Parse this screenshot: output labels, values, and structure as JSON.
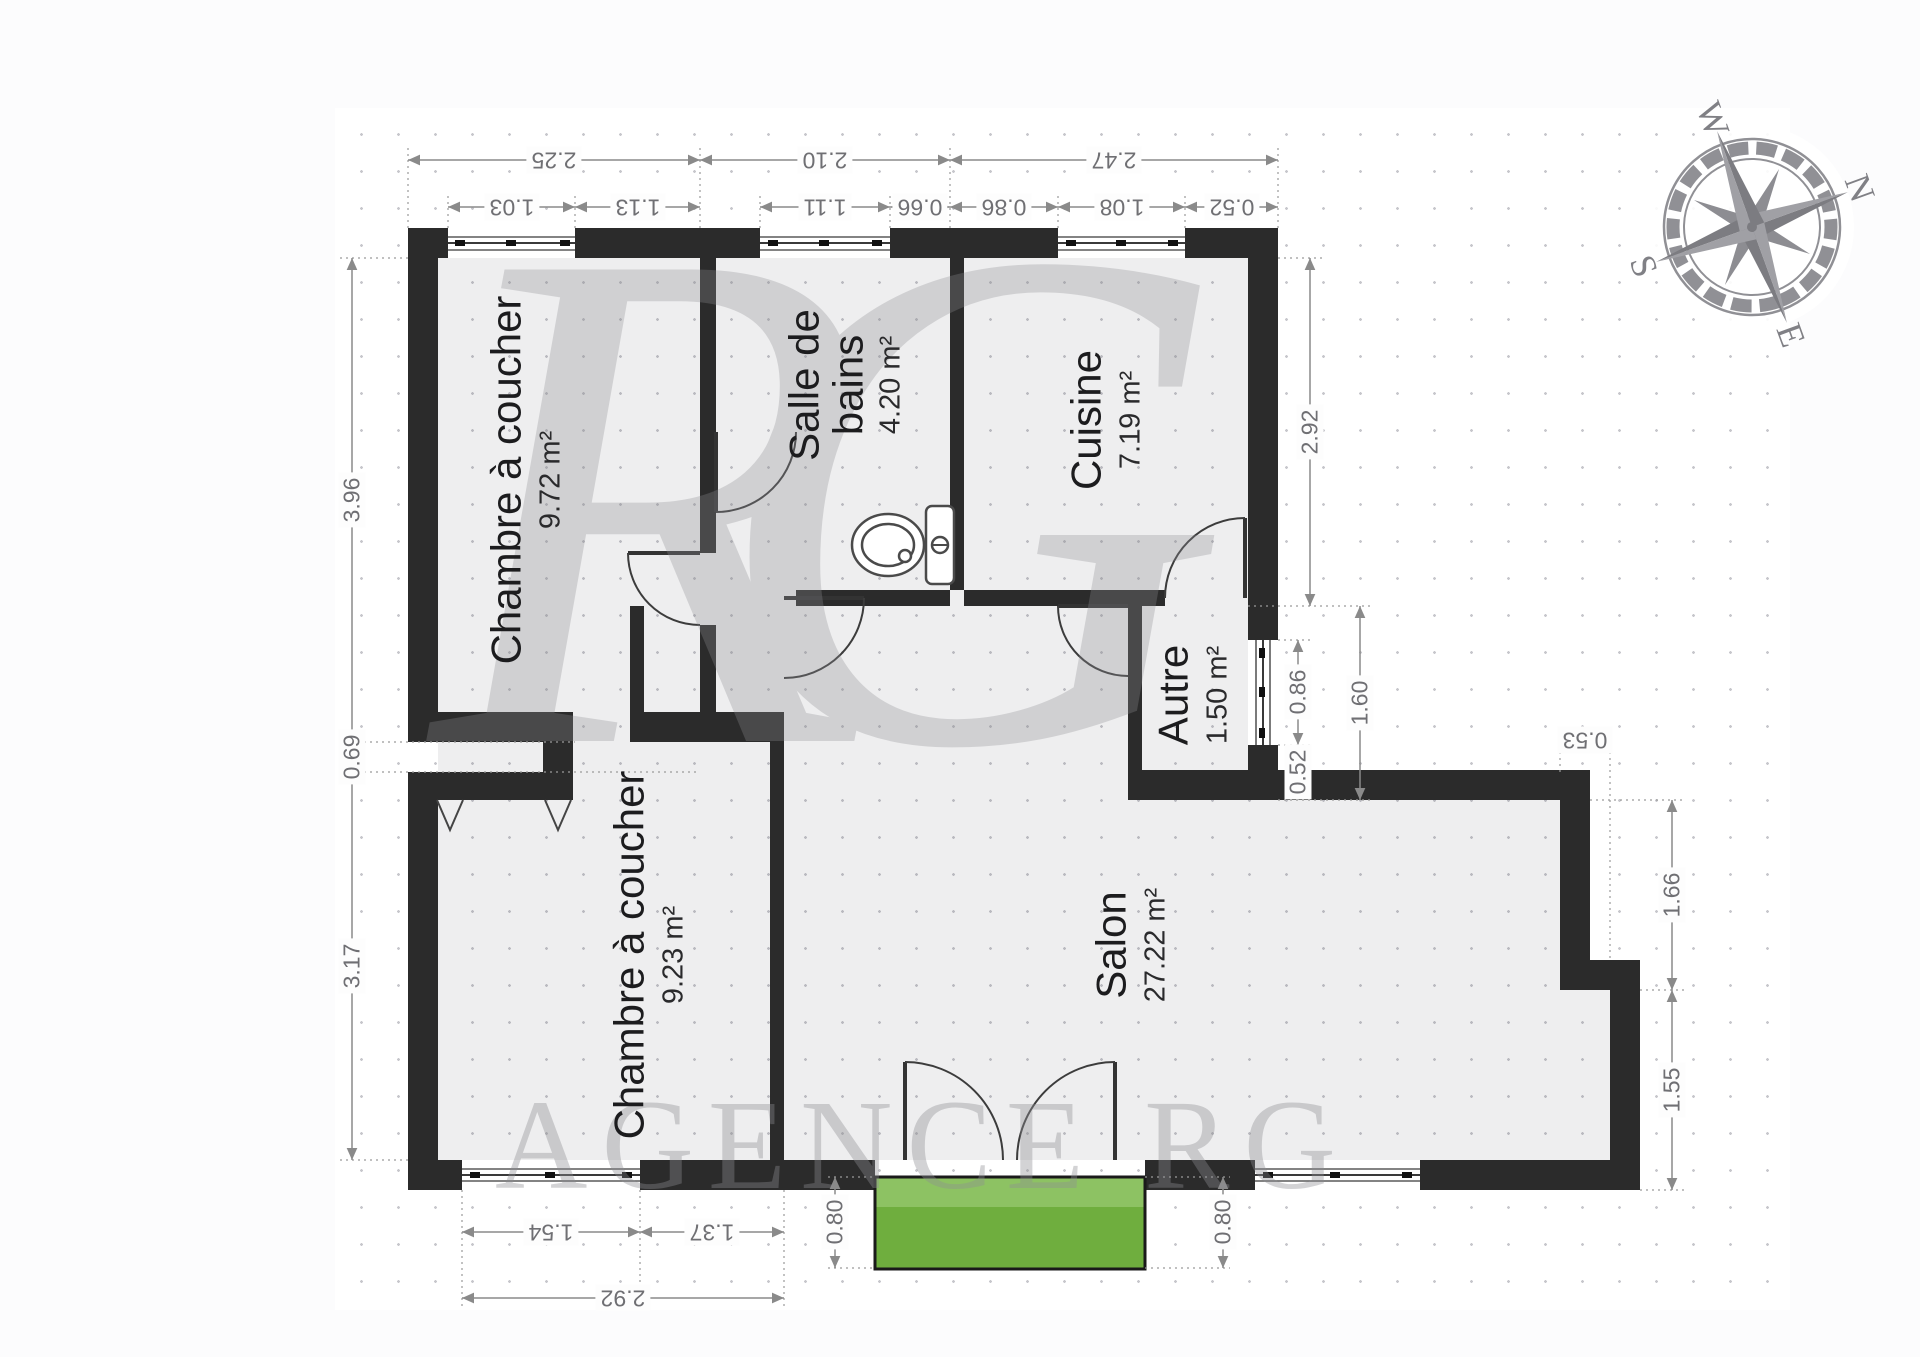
{
  "rooms": [
    {
      "id": "bedroom-1",
      "name": "Chambre à coucher",
      "area": "9.72 m²"
    },
    {
      "id": "bathroom",
      "name": "Salle de bains",
      "area": "4.20 m²"
    },
    {
      "id": "kitchen",
      "name": "Cuisine",
      "area": "7.19 m²"
    },
    {
      "id": "other",
      "name": "Autre",
      "area": "1.50 m²"
    },
    {
      "id": "living-room",
      "name": "Salon",
      "area": "27.22 m²"
    },
    {
      "id": "bedroom-2",
      "name": "Chambre à coucher",
      "area": "9.23 m²"
    }
  ],
  "dims": {
    "top_main": [
      "2.25",
      "2.10",
      "2.47"
    ],
    "top_sub": [
      "1.03",
      "1.13",
      "1.11",
      "0.66",
      "0.86",
      "1.08",
      "0.52"
    ],
    "left": [
      "3.96",
      "0.69",
      "3.17"
    ],
    "kitchen_right": [
      "2.92"
    ],
    "other_right": [
      "0.86",
      "0.52",
      "1.60"
    ],
    "salon_right": [
      "0.53",
      "1.66",
      "1.55"
    ],
    "bottom_sub": [
      "1.54",
      "1.37"
    ],
    "bottom_main": [
      "2.92"
    ],
    "entrance": [
      "0.80",
      "0.80"
    ]
  },
  "compass": {
    "n": "N",
    "e": "E",
    "s": "S",
    "w": "W"
  },
  "watermark": {
    "monogram": "RG",
    "agency_text": "AGENCE RG"
  },
  "colors": {
    "wall": "#2b2b2b",
    "floor": "#e9e9ec",
    "entrance_green_light": "#8dc263",
    "entrance_green_dark": "#6fae3e",
    "dimension_gray": "#8a8a8a",
    "watermark_gray": "#8e8e93"
  }
}
